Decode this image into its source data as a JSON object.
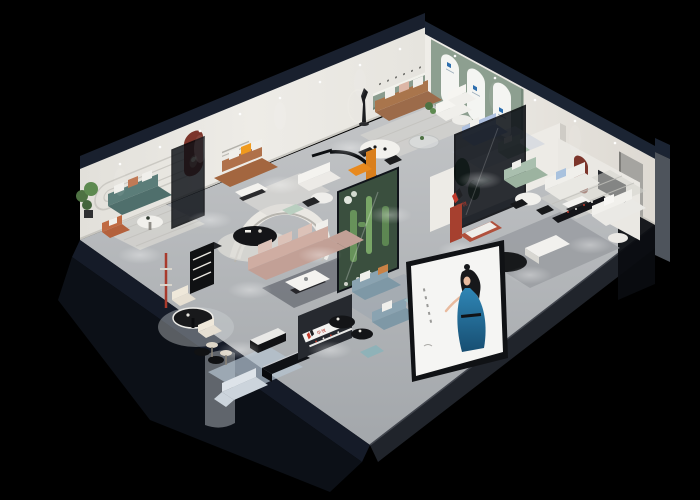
{
  "scene": {
    "title": "Furniture showroom 3D cutaway",
    "description": "Isometric night-time cutaway render of a furniture brand showroom interior on a black background",
    "background_color": "#000000"
  },
  "brand": {
    "name": "华悦",
    "mark": "two-bar H monogram",
    "mark_red": "#c23a2c",
    "mark_dark": "#202124"
  },
  "poster": {
    "subject": "fashion model in blue evening dress",
    "panel_color": "#f5f5f3",
    "dress_color": "#2a7fae",
    "caption_marks": "small vertical tagline print"
  },
  "palette": {
    "outer_wall_navy": "#1a2232",
    "inner_wall": "#e9e7e2",
    "floor_gray": "#b6b9bc",
    "sage_feature_wall": "#8d9f90",
    "arch_niche_red": "#7c352b",
    "teal_sofa": "#4f6f6c",
    "leather_brown": "#a3663f",
    "mauve_sectional": "#c2a096",
    "periwinkle_sofa": "#a2b6d8",
    "orange_accent": "#e8891d",
    "cactus_green": "#5c8a4e",
    "steel_blue_sofa": "#7e98a6"
  },
  "areas": [
    "teal sofa lounge",
    "leather loveseat nook",
    "brown sofa living display",
    "arched gallery wall",
    "glass-walled blue sofa lounge",
    "cactus terrarium",
    "mauve sectional living room",
    "dining and bar corner",
    "reception with brand shelf",
    "white sofa display rooms",
    "street-front poster wall"
  ]
}
